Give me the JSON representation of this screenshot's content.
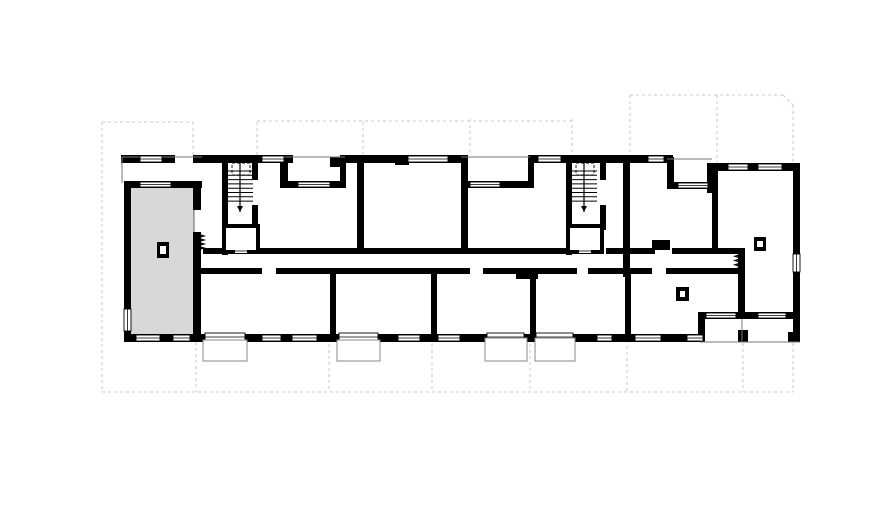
{
  "view": {
    "width": 888,
    "height": 532,
    "background": "#ffffff"
  },
  "colors": {
    "wall": "#000000",
    "building_fill": "#ffffff",
    "highlight_fill": "#d8d8d8",
    "highlight_stroke": "#000000",
    "grid_dash": "#c9c9c9",
    "thin_line": "#777777",
    "balcony_stroke": "#8a8a8a",
    "window_stroke": "#000000"
  },
  "plan": {
    "selected_unit": {
      "x": 126,
      "y": 186,
      "w": 68,
      "h": 150
    },
    "building_polygon": "121,155 712,155 712,163 800,163 800,342 124,342",
    "grid": {
      "dash_pattern": "3,3",
      "verticals": [
        [
          102,
          122,
          392
        ],
        [
          193,
          122,
          156
        ],
        [
          257,
          122,
          156
        ],
        [
          363,
          122,
          156
        ],
        [
          470,
          119,
          156
        ],
        [
          572,
          119,
          156
        ],
        [
          630,
          95,
          158
        ],
        [
          717,
          95,
          164
        ],
        [
          793,
          105,
          164
        ],
        [
          196,
          342,
          392
        ],
        [
          329,
          338,
          392
        ],
        [
          432,
          338,
          392
        ],
        [
          530,
          338,
          392
        ],
        [
          627,
          340,
          392
        ],
        [
          743,
          343,
          392
        ],
        [
          793,
          343,
          392
        ]
      ],
      "horizontals": [
        [
          102,
          193,
          122
        ],
        [
          257,
          572,
          121
        ],
        [
          630,
          783,
          95
        ],
        [
          102,
          793,
          392
        ]
      ],
      "diagonals": [
        [
          783,
          95,
          793,
          105
        ]
      ]
    },
    "walls": [
      [
        121,
        155,
        12,
        8
      ],
      [
        131,
        155,
        44,
        8
      ],
      [
        193,
        155,
        100,
        8
      ],
      [
        345,
        155,
        123,
        8
      ],
      [
        530,
        155,
        143,
        8
      ],
      [
        712,
        163,
        88,
        8
      ],
      [
        124,
        181,
        78,
        7
      ],
      [
        280,
        181,
        65,
        7
      ],
      [
        461,
        181,
        69,
        7
      ],
      [
        667,
        182,
        46,
        7
      ],
      [
        280,
        155,
        8,
        33
      ],
      [
        340,
        155,
        6,
        33
      ],
      [
        528,
        155,
        6,
        33
      ],
      [
        667,
        157,
        7,
        32
      ],
      [
        707,
        163,
        10,
        30
      ],
      [
        124,
        183,
        7,
        159
      ],
      [
        193,
        185,
        8,
        25
      ],
      [
        193,
        232,
        8,
        110
      ],
      [
        222,
        155,
        6,
        100
      ],
      [
        252,
        155,
        6,
        25
      ],
      [
        252,
        205,
        6,
        25
      ],
      [
        566,
        155,
        6,
        100
      ],
      [
        600,
        155,
        6,
        25
      ],
      [
        600,
        205,
        6,
        25
      ],
      [
        357,
        155,
        7,
        99
      ],
      [
        461,
        155,
        7,
        99
      ],
      [
        623,
        157,
        7,
        120
      ],
      [
        712,
        168,
        6,
        84
      ],
      [
        203,
        248,
        19,
        6
      ],
      [
        258,
        248,
        99,
        6
      ],
      [
        364,
        248,
        97,
        6
      ],
      [
        468,
        248,
        98,
        6
      ],
      [
        606,
        248,
        17,
        6
      ],
      [
        630,
        248,
        25,
        6
      ],
      [
        672,
        248,
        68,
        6
      ],
      [
        195,
        268,
        67,
        6
      ],
      [
        276,
        268,
        194,
        6
      ],
      [
        483,
        268,
        94,
        6
      ],
      [
        588,
        268,
        64,
        6
      ],
      [
        666,
        268,
        78,
        6
      ],
      [
        330,
        274,
        6,
        62
      ],
      [
        431,
        274,
        6,
        62
      ],
      [
        530,
        274,
        6,
        62
      ],
      [
        625,
        274,
        6,
        62
      ],
      [
        738,
        248,
        7,
        70
      ],
      [
        124,
        334,
        580,
        8
      ],
      [
        700,
        312,
        100,
        7
      ],
      [
        698,
        312,
        7,
        30
      ],
      [
        793,
        163,
        7,
        179
      ],
      [
        788,
        332,
        12,
        10
      ],
      [
        738,
        330,
        10,
        12
      ],
      [
        330,
        157,
        16,
        10
      ],
      [
        395,
        157,
        14,
        8
      ],
      [
        516,
        270,
        22,
        9
      ],
      [
        652,
        240,
        18,
        10
      ]
    ],
    "windows": [
      [
        140,
        156,
        22,
        6
      ],
      [
        262,
        156,
        22,
        6
      ],
      [
        408,
        156,
        40,
        6
      ],
      [
        538,
        156,
        23,
        6
      ],
      [
        648,
        156,
        16,
        6
      ],
      [
        728,
        164,
        20,
        6
      ],
      [
        758,
        164,
        24,
        6
      ],
      [
        140,
        182,
        31,
        5
      ],
      [
        298,
        182,
        32,
        5
      ],
      [
        470,
        182,
        30,
        5
      ],
      [
        678,
        183,
        30,
        5
      ],
      [
        136,
        335,
        24,
        6
      ],
      [
        173,
        335,
        17,
        6
      ],
      [
        262,
        335,
        19,
        6
      ],
      [
        292,
        335,
        25,
        6
      ],
      [
        398,
        335,
        22,
        6
      ],
      [
        438,
        335,
        22,
        6
      ],
      [
        597,
        335,
        15,
        6
      ],
      [
        635,
        335,
        26,
        6
      ],
      [
        687,
        335,
        16,
        6
      ],
      [
        205,
        333,
        40,
        8
      ],
      [
        339,
        333,
        39,
        8
      ],
      [
        487,
        333,
        37,
        8
      ],
      [
        536,
        333,
        37,
        8
      ],
      [
        706,
        313,
        30,
        5
      ],
      [
        758,
        313,
        28,
        5
      ],
      [
        124,
        309,
        7,
        22
      ],
      [
        793,
        254,
        7,
        18
      ]
    ],
    "balconies": [
      [
        203,
        340,
        44,
        21
      ],
      [
        337,
        340,
        43,
        21
      ],
      [
        485,
        338,
        42,
        23
      ],
      [
        535,
        338,
        40,
        23
      ]
    ],
    "thin_lines": [
      [
        122,
        157,
        202,
        157
      ],
      [
        122,
        157,
        122,
        183
      ],
      [
        280,
        157,
        345,
        157
      ],
      [
        461,
        157,
        530,
        157
      ],
      [
        667,
        159,
        712,
        159
      ],
      [
        700,
        342,
        800,
        342
      ],
      [
        742,
        319,
        742,
        341
      ]
    ],
    "stairs": [
      {
        "x": 227,
        "y": 161,
        "w": 26,
        "h": 47
      },
      {
        "x": 571,
        "y": 161,
        "w": 26,
        "h": 47
      }
    ],
    "elevators": [
      [
        224,
        226,
        34,
        26
      ],
      [
        568,
        226,
        34,
        26
      ]
    ],
    "columns": [
      {
        "rect": [
          157,
          242,
          12,
          16
        ],
        "inner": [
          160,
          246,
          6,
          8
        ]
      },
      {
        "rect": [
          676,
          287,
          13,
          14
        ],
        "inner": [
          680,
          291,
          5,
          6
        ]
      },
      {
        "rect": [
          754,
          237,
          12,
          14
        ],
        "inner": [
          757,
          241,
          6,
          6
        ]
      }
    ],
    "springs": [
      {
        "x": 197,
        "y": 234,
        "len": 16
      },
      {
        "x": 735,
        "y": 252,
        "len": 17
      }
    ]
  }
}
